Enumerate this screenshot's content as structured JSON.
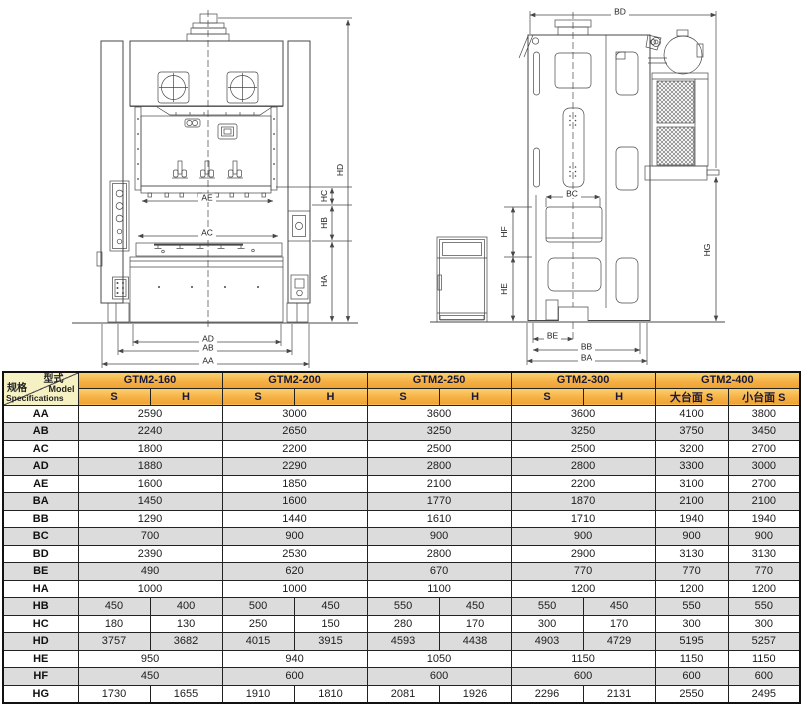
{
  "colors": {
    "amber_top": "#FBD26F",
    "amber_mid": "#F5AE43",
    "amber_bottom": "#EFA433",
    "corner_bg": "#F6F1C3",
    "row_shaded": "#DCDCDC",
    "line": "#474747"
  },
  "drawing": {
    "labels": {
      "AA": "AA",
      "AB": "AB",
      "AC": "AC",
      "AD": "AD",
      "AE": "AE",
      "BA": "BA",
      "BB": "BB",
      "BC": "BC",
      "BD": "BD",
      "BE": "BE",
      "HA": "HA",
      "HB": "HB",
      "HC": "HC",
      "HD": "HD",
      "HE": "HE",
      "HF": "HF",
      "HG": "HG"
    }
  },
  "table": {
    "corner": {
      "top_cn": "型式",
      "top_en": "Model",
      "bottom_cn": "规格",
      "bottom_en": "Specifications"
    },
    "models": [
      "GTM2-160",
      "GTM2-200",
      "GTM2-250",
      "GTM2-300",
      "GTM2-400"
    ],
    "subheaders": [
      "S",
      "H",
      "S",
      "H",
      "S",
      "H",
      "S",
      "H",
      "大台面 S",
      "小台面 S"
    ],
    "rows": [
      {
        "label": "AA",
        "spans": [
          2,
          2,
          2,
          2,
          1,
          1
        ],
        "values": [
          "2590",
          "3000",
          "3600",
          "3600",
          "4100",
          "3800"
        ]
      },
      {
        "label": "AB",
        "spans": [
          2,
          2,
          2,
          2,
          1,
          1
        ],
        "values": [
          "2240",
          "2650",
          "3250",
          "3250",
          "3750",
          "3450"
        ]
      },
      {
        "label": "AC",
        "spans": [
          2,
          2,
          2,
          2,
          1,
          1
        ],
        "values": [
          "1800",
          "2200",
          "2500",
          "2500",
          "3200",
          "2700"
        ]
      },
      {
        "label": "AD",
        "spans": [
          2,
          2,
          2,
          2,
          1,
          1
        ],
        "values": [
          "1880",
          "2290",
          "2800",
          "2800",
          "3300",
          "3000"
        ]
      },
      {
        "label": "AE",
        "spans": [
          2,
          2,
          2,
          2,
          1,
          1
        ],
        "values": [
          "1600",
          "1850",
          "2100",
          "2200",
          "3100",
          "2700"
        ]
      },
      {
        "label": "BA",
        "spans": [
          2,
          2,
          2,
          2,
          1,
          1
        ],
        "values": [
          "1450",
          "1600",
          "1770",
          "1870",
          "2100",
          "2100"
        ]
      },
      {
        "label": "BB",
        "spans": [
          2,
          2,
          2,
          2,
          1,
          1
        ],
        "values": [
          "1290",
          "1440",
          "1610",
          "1710",
          "1940",
          "1940"
        ]
      },
      {
        "label": "BC",
        "spans": [
          2,
          2,
          2,
          2,
          1,
          1
        ],
        "values": [
          "700",
          "900",
          "900",
          "900",
          "900",
          "900"
        ]
      },
      {
        "label": "BD",
        "spans": [
          2,
          2,
          2,
          2,
          1,
          1
        ],
        "values": [
          "2390",
          "2530",
          "2800",
          "2900",
          "3130",
          "3130"
        ]
      },
      {
        "label": "BE",
        "spans": [
          2,
          2,
          2,
          2,
          1,
          1
        ],
        "values": [
          "490",
          "620",
          "670",
          "770",
          "770",
          "770"
        ]
      },
      {
        "label": "HA",
        "spans": [
          2,
          2,
          2,
          2,
          1,
          1
        ],
        "values": [
          "1000",
          "1000",
          "1100",
          "1200",
          "1200",
          "1200"
        ]
      },
      {
        "label": "HB",
        "spans": [
          1,
          1,
          1,
          1,
          1,
          1,
          1,
          1,
          1,
          1
        ],
        "values": [
          "450",
          "400",
          "500",
          "450",
          "550",
          "450",
          "550",
          "450",
          "550",
          "550"
        ]
      },
      {
        "label": "HC",
        "spans": [
          1,
          1,
          1,
          1,
          1,
          1,
          1,
          1,
          1,
          1
        ],
        "values": [
          "180",
          "130",
          "250",
          "150",
          "280",
          "170",
          "300",
          "170",
          "300",
          "300"
        ]
      },
      {
        "label": "HD",
        "spans": [
          1,
          1,
          1,
          1,
          1,
          1,
          1,
          1,
          1,
          1
        ],
        "values": [
          "3757",
          "3682",
          "4015",
          "3915",
          "4593",
          "4438",
          "4903",
          "4729",
          "5195",
          "5257"
        ]
      },
      {
        "label": "HE",
        "spans": [
          2,
          2,
          2,
          2,
          1,
          1
        ],
        "values": [
          "950",
          "940",
          "1050",
          "1150",
          "1150",
          "1150"
        ]
      },
      {
        "label": "HF",
        "spans": [
          2,
          2,
          2,
          2,
          1,
          1
        ],
        "values": [
          "450",
          "600",
          "600",
          "600",
          "600",
          "600"
        ]
      },
      {
        "label": "HG",
        "spans": [
          1,
          1,
          1,
          1,
          1,
          1,
          1,
          1,
          1,
          1
        ],
        "values": [
          "1730",
          "1655",
          "1910",
          "1810",
          "2081",
          "1926",
          "2296",
          "2131",
          "2550",
          "2495"
        ]
      }
    ]
  }
}
